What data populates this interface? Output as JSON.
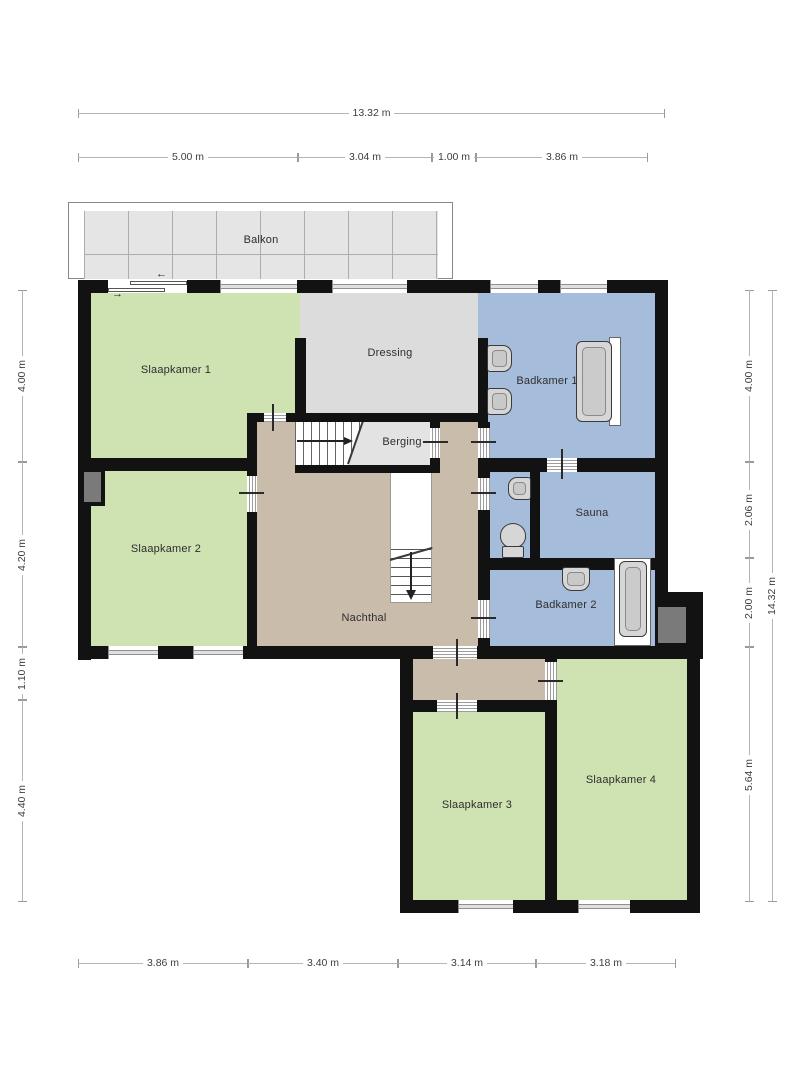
{
  "floor_plan": {
    "rooms": {
      "balkon": "Balkon",
      "slaapkamer1": "Slaapkamer 1",
      "dressing": "Dressing",
      "badkamer1": "Badkamer 1",
      "berging": "Berging",
      "slaapkamer2": "Slaapkamer 2",
      "nachthal": "Nachthal",
      "sauna": "Sauna",
      "badkamer2": "Badkamer 2",
      "slaapkamer3": "Slaapkamer 3",
      "slaapkamer4": "Slaapkamer 4"
    },
    "dimensions": {
      "top_total": "13.32 m",
      "top_segments": [
        "5.00 m",
        "3.04 m",
        "1.00 m",
        "3.86 m"
      ],
      "left_segments": [
        "4.00 m",
        "4.20 m",
        "1.10 m",
        "4.40 m"
      ],
      "right_segments": [
        "4.00 m",
        "2.06 m",
        "2.00 m",
        "5.64 m"
      ],
      "right_total": "14.32 m",
      "bottom_segments": [
        "3.86 m",
        "3.40 m",
        "3.14 m",
        "3.18 m"
      ]
    },
    "fixtures": {
      "badkamer1": [
        "sink",
        "sink",
        "bathtub"
      ],
      "wc": [
        "sink",
        "toilet"
      ],
      "badkamer2": [
        "sink",
        "bathtub"
      ],
      "stairs": [
        "up-flight-arrow-right",
        "down-flight-arrow-down"
      ]
    },
    "arrows": {
      "slider_left": "←",
      "slider_right": "→"
    },
    "colors": {
      "bedroom": "#cfe2b2",
      "bathroom": "#a6bcdb",
      "hall": "#c9bcab",
      "dressing": "#dcdcdc",
      "storage": "#e3e3e3",
      "balcony_tile": "#e5e5e5",
      "wall": "#121212",
      "shaft": "#7a7a7a"
    }
  }
}
